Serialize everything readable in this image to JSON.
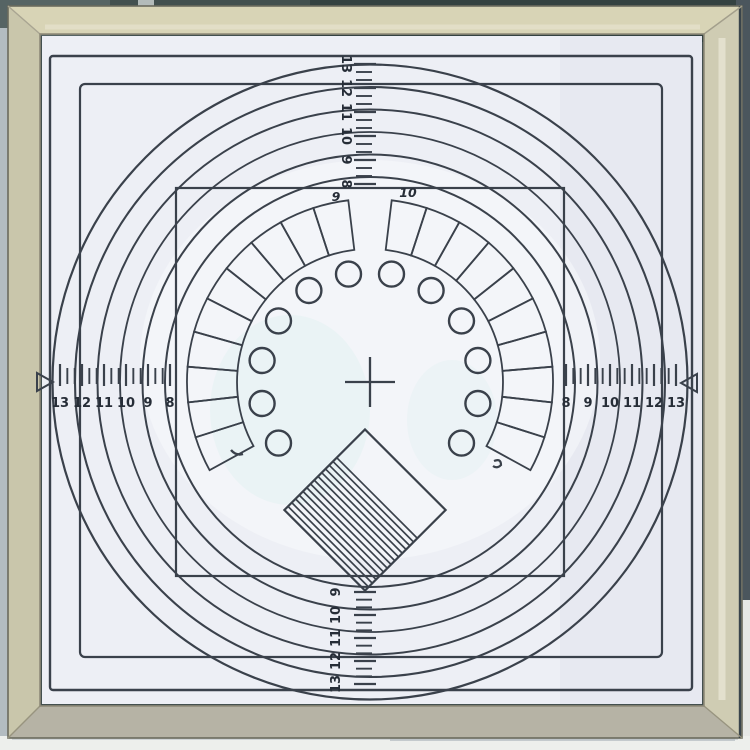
{
  "scales": {
    "left": {
      "values": [
        "13",
        "12",
        "11",
        "10",
        "9",
        "8"
      ]
    },
    "right": {
      "values": [
        "8",
        "9",
        "10",
        "11",
        "12",
        "13"
      ]
    },
    "top": {
      "values": [
        "13",
        "12",
        "11",
        "10",
        "9",
        "8"
      ]
    },
    "bottom": {
      "values": [
        "9",
        "10",
        "11",
        "12",
        "13"
      ]
    }
  },
  "sector_ring": {
    "label_left": "9",
    "label_right": "10"
  },
  "icons": {
    "left_pointer": "right-facing-triangle",
    "right_pointer": "left-facing-triangle"
  },
  "colors": {
    "ink": "#3a414b",
    "digits": "#262d37",
    "paper": "#edeff5",
    "paper_shade": "#e2e4ee",
    "paper_tint": "#ddefef",
    "frame_top": "#d8d4b6",
    "frame_side": "#cfccb3",
    "frame_left": "#c9c6ab",
    "frame_bottom": "#b6b3a5",
    "frame_edge": "#8f8b79",
    "bg_top": "#42504f",
    "bg_top_dark": "#2c3a3a",
    "bg_right": "#4b565d",
    "table": "#edefec",
    "shadow": "#c6ccd0"
  }
}
